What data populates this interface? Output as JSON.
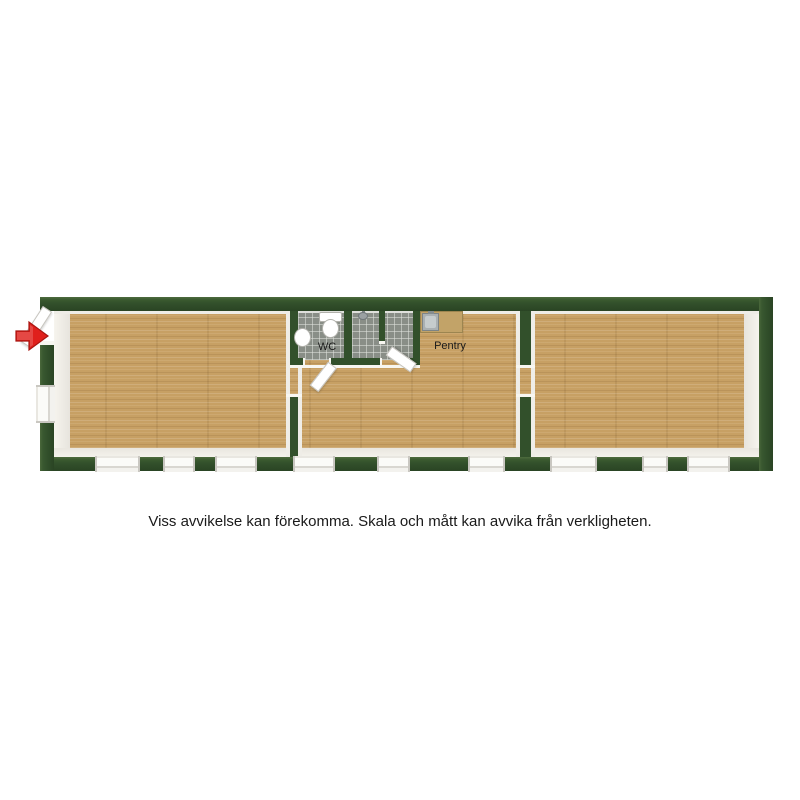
{
  "plan": {
    "disclaimer": "Viss avvikelse kan förekomma. Skala och mått kan avvika från verkligheten.",
    "labels": {
      "wc": "WC",
      "pentry": "Pentry"
    },
    "icons": {
      "entrance_arrow": "entrance-direction-arrow",
      "shower_head": "shower-head"
    },
    "colors": {
      "background": "#ffffff",
      "wall": "#32502b",
      "floor_wood": "#c7a064",
      "floor_tile": "#898e87",
      "counter": "#c2a368",
      "door": "#ffffff",
      "window": "#fbfbf8",
      "arrow_red": "#e0201c",
      "text": "#1a1a1a"
    }
  }
}
